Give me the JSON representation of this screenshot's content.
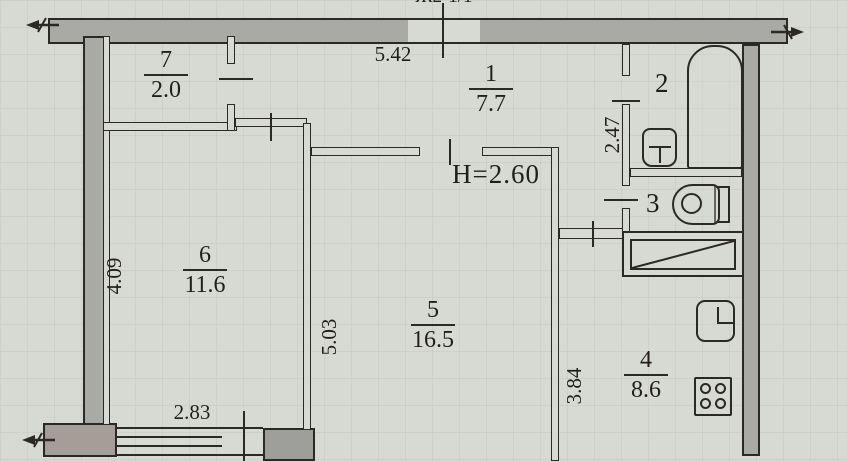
{
  "plan": {
    "corner_label": "Ж2-1/1",
    "height_note": "H=2.60",
    "rooms": {
      "r1": {
        "num": "1",
        "area": "7.7"
      },
      "r2": {
        "num": "2"
      },
      "r3": {
        "num": "3"
      },
      "r4": {
        "num": "4",
        "area": "8.6"
      },
      "r5": {
        "num": "5",
        "area": "16.5"
      },
      "r6": {
        "num": "6",
        "area": "11.6"
      },
      "r7": {
        "num": "7",
        "area": "2.0"
      }
    },
    "dims": {
      "top": "5.42",
      "left": "4.09",
      "bath": "2.47",
      "room5": "5.03",
      "kitchen": "3.84",
      "window": "2.83"
    },
    "colors": {
      "paper": "#d7d9d3",
      "wall_fill": "#a9a9a5",
      "line": "#2b2925"
    }
  }
}
